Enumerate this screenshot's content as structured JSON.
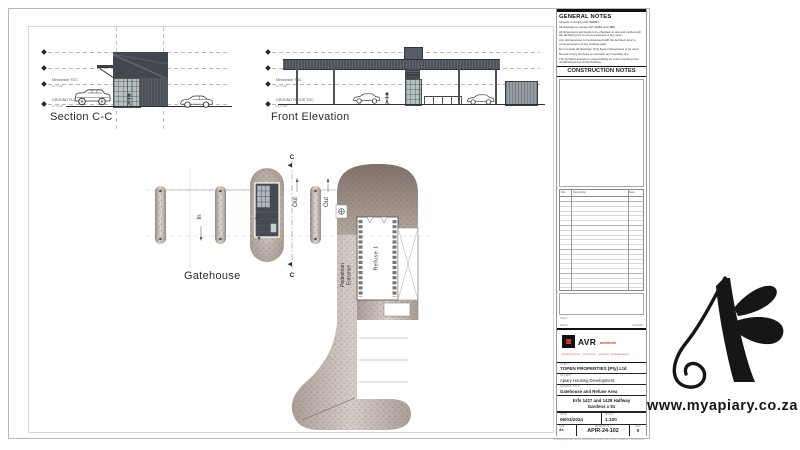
{
  "drawings": {
    "section": {
      "title": "Section C-C",
      "mezzanine_label": "Mezzanine TOC",
      "mezzanine_level": "SL 3.400",
      "ground_label": "GROUND FLOOR TOC",
      "ground_level": "SL 0.000"
    },
    "front_elevation": {
      "title": "Front Elevation",
      "mezzanine_label": "Mezzanine TOC",
      "mezzanine_level": "SL 3.400",
      "ground_label": "GROUND FLOOR TOC",
      "ground_level": "SL 0.000"
    },
    "plan": {
      "title": "Gatehouse",
      "in_label": "In",
      "out_label": "Out",
      "section_marker": "C",
      "pedestrian_line1": "Pedestrian",
      "pedestrian_line2": "Entrance",
      "refuse_label": "Refuse 1"
    }
  },
  "notes_panel": {
    "general_title": "GENERAL NOTES",
    "general_notes": [
      "All work to comply with NHBRC.",
      "All drawings to comply with SABS and NBR.",
      "All dimensions and levels to be checked on site and verified with the architect prior to commencement of any work.",
      "Any discrepancies to be discussed with the Architect prior to commencement of any building work.",
      "Do not scale off drawings. Only figured dimensions to be used.",
      "No part of any structure to encroach any boundary line.",
      "The Architect accepts no responsibility for errors resulting from unauthorised use of this drawing.",
      "This drawing is protected by copyright and remains the property of the registered architect as appointed."
    ],
    "construction_title": "CONSTRUCTION NOTES",
    "revision_table": {
      "rev_header": "Rev",
      "description_header": "Description",
      "date_header": "Date"
    },
    "notes_caption": "Notes:"
  },
  "title_block": {
    "drawn_label": "Drawn",
    "checked_label": "Checked",
    "logo_text": "AVR",
    "logo_suffix": "architects",
    "logo_tagline": "architecture  ·  interiors  ·  project management",
    "client_label": "CLIENT",
    "client": "TOPEN PROPERTIES (Pty) Ltd",
    "project_label": "PROJECT",
    "project": "Apiary Housing Development",
    "drawing_label": "DRAWING TITLE",
    "drawing": "Gatehouse and Refuse Area",
    "address_line1": "Erfs 1427 and 1428 Halfway",
    "address_line2": "Gardens x 81",
    "date_label": "DATE",
    "date": "06/03/2024",
    "scale_label": "SCALE",
    "scale": "1:100",
    "size_label": "SIZE",
    "size": "A1",
    "number_label": "DRAWING No.",
    "number": "APIR-24-102",
    "rev_label": "REV",
    "rev": "0",
    "footer": "This drawing may not be reproduced without the written consent of the architect."
  },
  "watermark": {
    "url": "www.myapiary.co.za"
  },
  "colors": {
    "avr_red": "#c0392b",
    "canopy_dark": "#4e525a",
    "plan_texture_base": "#c9beb8",
    "logo_black": "#161616"
  }
}
